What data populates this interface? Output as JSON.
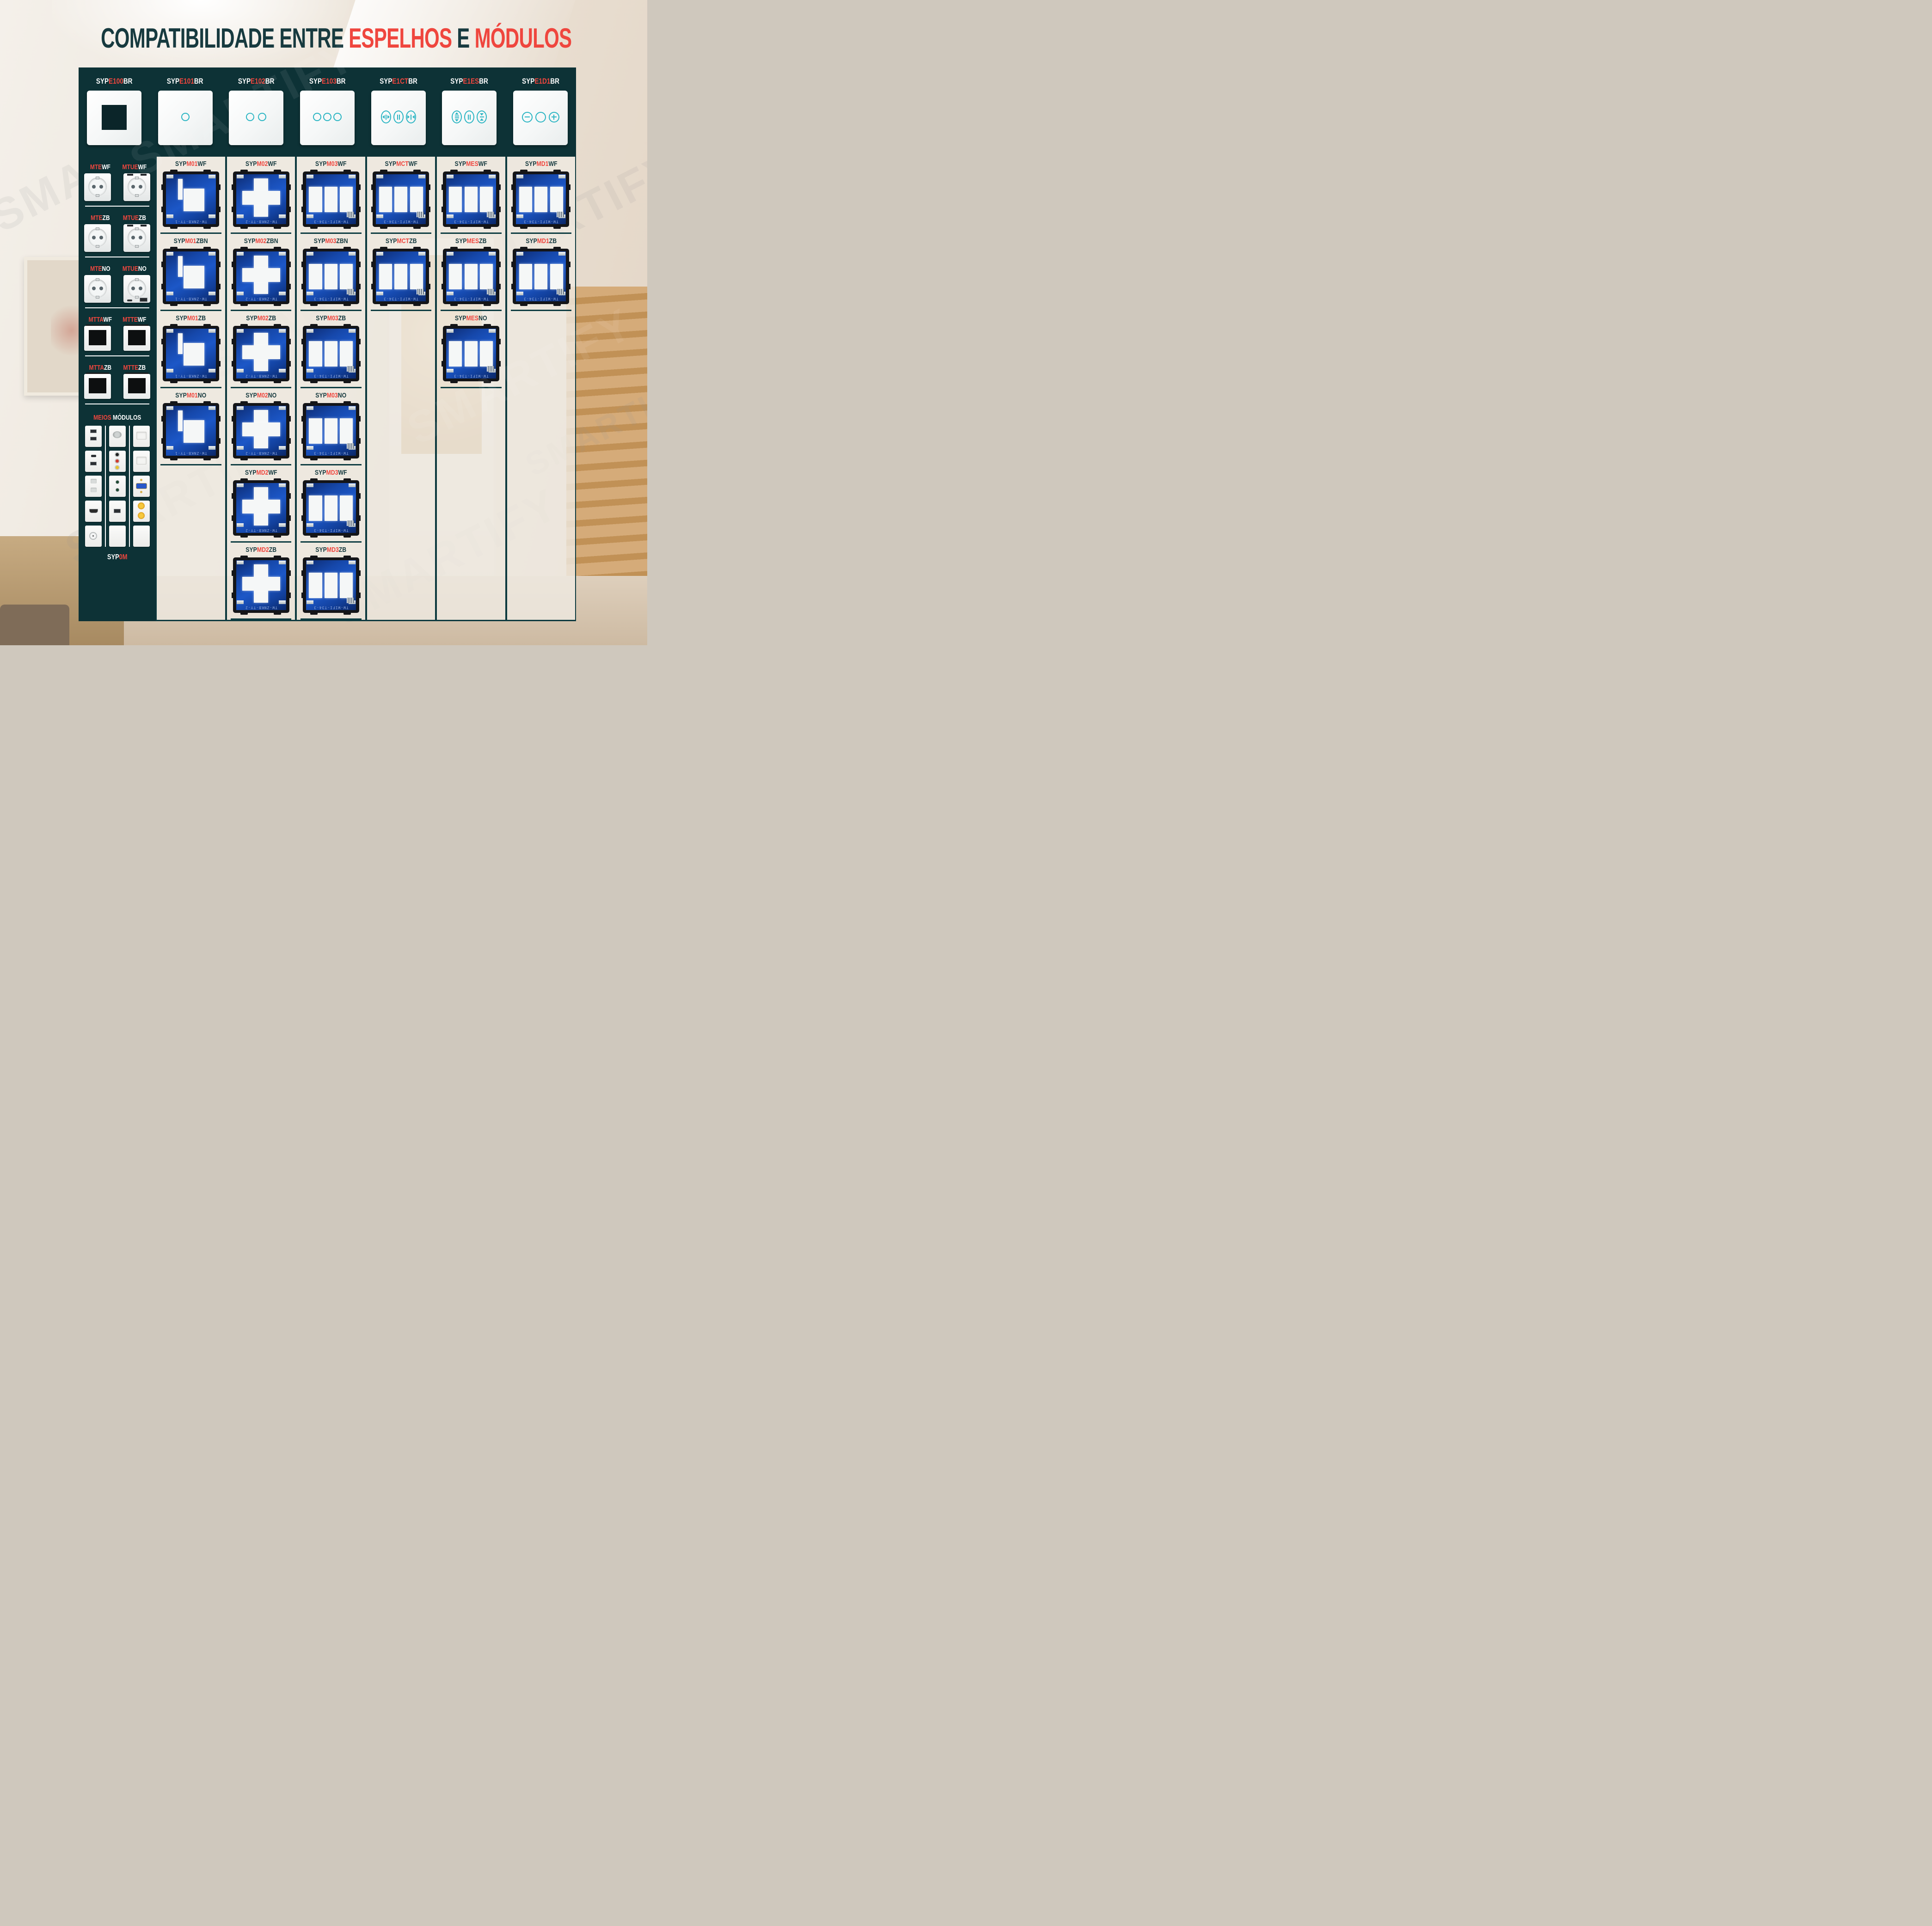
{
  "title": {
    "parts": [
      {
        "text": "COMPATIBILIDADE ENTRE ",
        "color": "teal"
      },
      {
        "text": "ESPELHOS",
        "color": "red"
      },
      {
        "text": " E ",
        "color": "teal"
      },
      {
        "text": "MÓDULOS",
        "color": "red"
      }
    ]
  },
  "watermark": "SMARTIFY",
  "colors": {
    "teal_dark": "#0d3236",
    "title_teal": "#173a3f",
    "red": "#ef463e",
    "label_teal": "#123c42",
    "icon_teal": "#2ab5c3",
    "strip_border": "#0d3a3f",
    "pcb_blue": "#1c57c7"
  },
  "header": {
    "cells": [
      {
        "code_parts": [
          "SYP",
          "E100",
          "BR"
        ],
        "panel": "blank-frame"
      },
      {
        "code_parts": [
          "SYP",
          "E101",
          "BR"
        ],
        "panel": "touch-1-button"
      },
      {
        "code_parts": [
          "SYP",
          "E102",
          "BR"
        ],
        "panel": "touch-2-button"
      },
      {
        "code_parts": [
          "SYP",
          "E103",
          "BR"
        ],
        "panel": "touch-3-button"
      },
      {
        "code_parts": [
          "SYP",
          "E1CT",
          "BR"
        ],
        "panel": "curtain-control"
      },
      {
        "code_parts": [
          "SYP",
          "E1ES",
          "BR"
        ],
        "panel": "shutter-control"
      },
      {
        "code_parts": [
          "SYP",
          "E1D1",
          "BR"
        ],
        "panel": "dimmer-control"
      }
    ]
  },
  "sidebar": {
    "groups": [
      {
        "items": [
          {
            "parts": [
              "MTE",
              "WF"
            ],
            "image": "schuko-socket"
          },
          {
            "parts": [
              "MTUE",
              "WF"
            ],
            "image": "schuko-socket-usb"
          }
        ]
      },
      {
        "items": [
          {
            "parts": [
              "MTE",
              "ZB"
            ],
            "image": "schuko-socket"
          },
          {
            "parts": [
              "MTUE",
              "ZB"
            ],
            "image": "schuko-socket-usb"
          }
        ]
      },
      {
        "items": [
          {
            "parts": [
              "MTE",
              "NO"
            ],
            "image": "schuko-socket"
          },
          {
            "parts": [
              "MTUE",
              "NO"
            ],
            "image": "schuko-socket-usb-c"
          }
        ]
      },
      {
        "items": [
          {
            "parts": [
              "MTTA",
              "WF"
            ],
            "image": "thermostat-plate"
          },
          {
            "parts": [
              "MTTE",
              "WF"
            ],
            "image": "thermostat-plate"
          }
        ]
      },
      {
        "items": [
          {
            "parts": [
              "MTTA",
              "ZB"
            ],
            "image": "thermostat-plate"
          },
          {
            "parts": [
              "MTTE",
              "ZB"
            ],
            "image": "thermostat-plate"
          }
        ]
      }
    ],
    "meios": {
      "label_parts": [
        "MEIOS",
        "MÓDULOS"
      ],
      "footer_parts": [
        "SYP",
        "0M"
      ],
      "tile_columns": [
        [
          "usb-double",
          "usb-c-a",
          "socket-2pin",
          "hdmi",
          "tv-coax"
        ],
        [
          "f-connector",
          "rca-triple",
          "minijack-double",
          "usb-single",
          "blank"
        ],
        [
          "keystone",
          "keystone",
          "vga",
          "rca-double-gold",
          "blank"
        ]
      ]
    }
  },
  "columns": [
    {
      "espelho": "SYPE101BR",
      "modules": [
        {
          "parts": [
            "SYP",
            "M01",
            "WF"
          ],
          "type": "single",
          "pcb_text": "TW-ZNKB-TY-1"
        },
        {
          "parts": [
            "SYP",
            "M01",
            "ZBN"
          ],
          "type": "single",
          "pcb_text": "TW-ZNKB-TY-1"
        },
        {
          "parts": [
            "SYP",
            "M01",
            "ZB"
          ],
          "type": "single",
          "pcb_text": "TW-ZNKB-TY-1"
        },
        {
          "parts": [
            "SYP",
            "M01",
            "NO"
          ],
          "type": "single",
          "pcb_text": "TW-ZNKB-TY-1"
        }
      ]
    },
    {
      "espelho": "SYPE102BR",
      "modules": [
        {
          "parts": [
            "SYP",
            "M02",
            "WF"
          ],
          "type": "cross",
          "pcb_text": "TW-ZNKB-TY-2"
        },
        {
          "parts": [
            "SYP",
            "M02",
            "ZBN"
          ],
          "type": "cross",
          "pcb_text": "TW-ZNKB-TY-2"
        },
        {
          "parts": [
            "SYP",
            "M02",
            "ZB"
          ],
          "type": "cross",
          "pcb_text": "TW-ZNKB-TY-2"
        },
        {
          "parts": [
            "SYP",
            "M02",
            "NO"
          ],
          "type": "cross",
          "pcb_text": "TW-ZNKB-TY-2"
        },
        {
          "parts": [
            "SYP",
            "MD2",
            "WF"
          ],
          "type": "cross",
          "pcb_text": "TW-ZNKB-TY-2"
        },
        {
          "parts": [
            "SYP",
            "MD2",
            "ZB"
          ],
          "type": "cross",
          "pcb_text": "TW-ZNKB-TY-2"
        }
      ]
    },
    {
      "espelho": "SYPE103BR",
      "modules": [
        {
          "parts": [
            "SYP",
            "M03",
            "WF"
          ],
          "type": "triple",
          "pcb_text": "TW-WIFI-T34-3"
        },
        {
          "parts": [
            "SYP",
            "M03",
            "ZBN"
          ],
          "type": "triple",
          "pcb_text": "TW-WIFI-T34-3"
        },
        {
          "parts": [
            "SYP",
            "M03",
            "ZB"
          ],
          "type": "triple",
          "pcb_text": "TW-WIFI-T34-3"
        },
        {
          "parts": [
            "SYP",
            "M03",
            "NO"
          ],
          "type": "triple",
          "pcb_text": "TW-WIFI-T34-3"
        },
        {
          "parts": [
            "SYP",
            "MD3",
            "WF"
          ],
          "type": "triple",
          "pcb_text": "TW-WIFI-T34-3"
        },
        {
          "parts": [
            "SYP",
            "MD3",
            "ZB"
          ],
          "type": "triple",
          "pcb_text": "TW-WIFI-T34-3"
        }
      ]
    },
    {
      "espelho": "SYPE1CTBR",
      "modules": [
        {
          "parts": [
            "SYP",
            "MCT",
            "WF"
          ],
          "type": "triple",
          "pcb_text": "TW-WIFI-T34-3"
        },
        {
          "parts": [
            "SYP",
            "MCT",
            "ZB"
          ],
          "type": "triple",
          "pcb_text": "TW-WIFI-T34-3"
        }
      ]
    },
    {
      "espelho": "SYPE1ESBR",
      "modules": [
        {
          "parts": [
            "SYP",
            "MES",
            "WF"
          ],
          "type": "triple",
          "pcb_text": "TW-WIFI-T34-3"
        },
        {
          "parts": [
            "SYP",
            "MES",
            "ZB"
          ],
          "type": "triple",
          "pcb_text": "TW-WIFI-T34-3"
        },
        {
          "parts": [
            "SYP",
            "MES",
            "NO"
          ],
          "type": "triple",
          "pcb_text": "TW-WIFI-T34-3"
        }
      ]
    },
    {
      "espelho": "SYPE1D1BR",
      "modules": [
        {
          "parts": [
            "SYP",
            "MD1",
            "WF"
          ],
          "type": "triple",
          "pcb_text": "TW-WIFI-T34-3"
        },
        {
          "parts": [
            "SYP",
            "MD1",
            "ZB"
          ],
          "type": "triple",
          "pcb_text": "TW-WIFI-T34-3"
        }
      ]
    }
  ]
}
